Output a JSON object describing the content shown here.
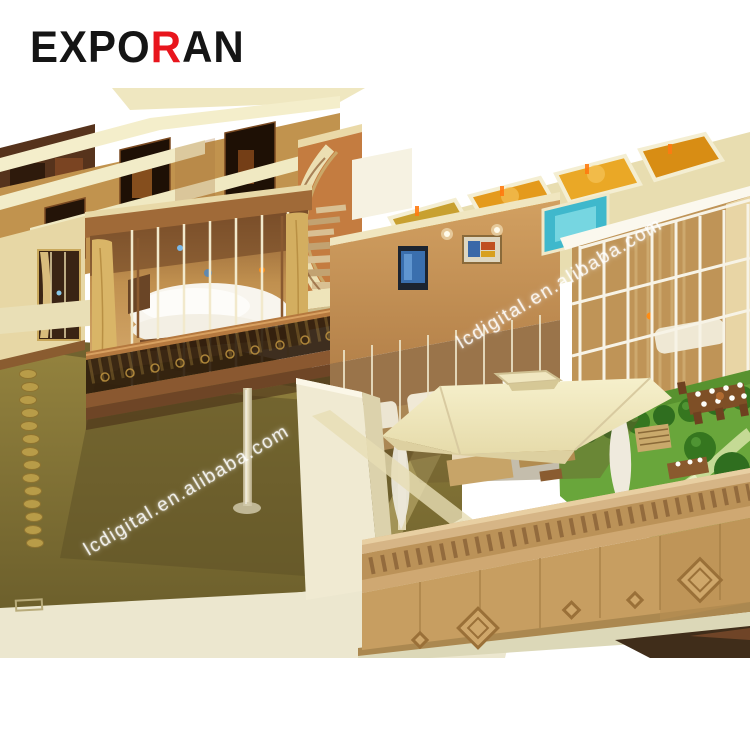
{
  "page": {
    "background_color": "#ffffff"
  },
  "brand": {
    "logo_primary": "EXPO",
    "logo_accent": "R",
    "logo_suffix": "AN",
    "logo_text_color": "#151515",
    "logo_accent_color": "#e8151d"
  },
  "photo": {
    "watermark_text": "lcdigital.en.alibaba.com",
    "watermark_color": "#ffffff",
    "watermark_angle_deg": -31,
    "palette": {
      "cream_wall": "#f1e8c2",
      "tan_wood": "#c89a5c",
      "dark_wood": "#5a3a20",
      "amber_room_light": "#e8a428",
      "teal_light": "#4fc0d4",
      "olive_floor": "#857536",
      "garden_green": "#5f9e34",
      "bed_white": "#f7f4ec",
      "base_platform": "#ece7cf",
      "table_dark": "#402d1a"
    }
  }
}
